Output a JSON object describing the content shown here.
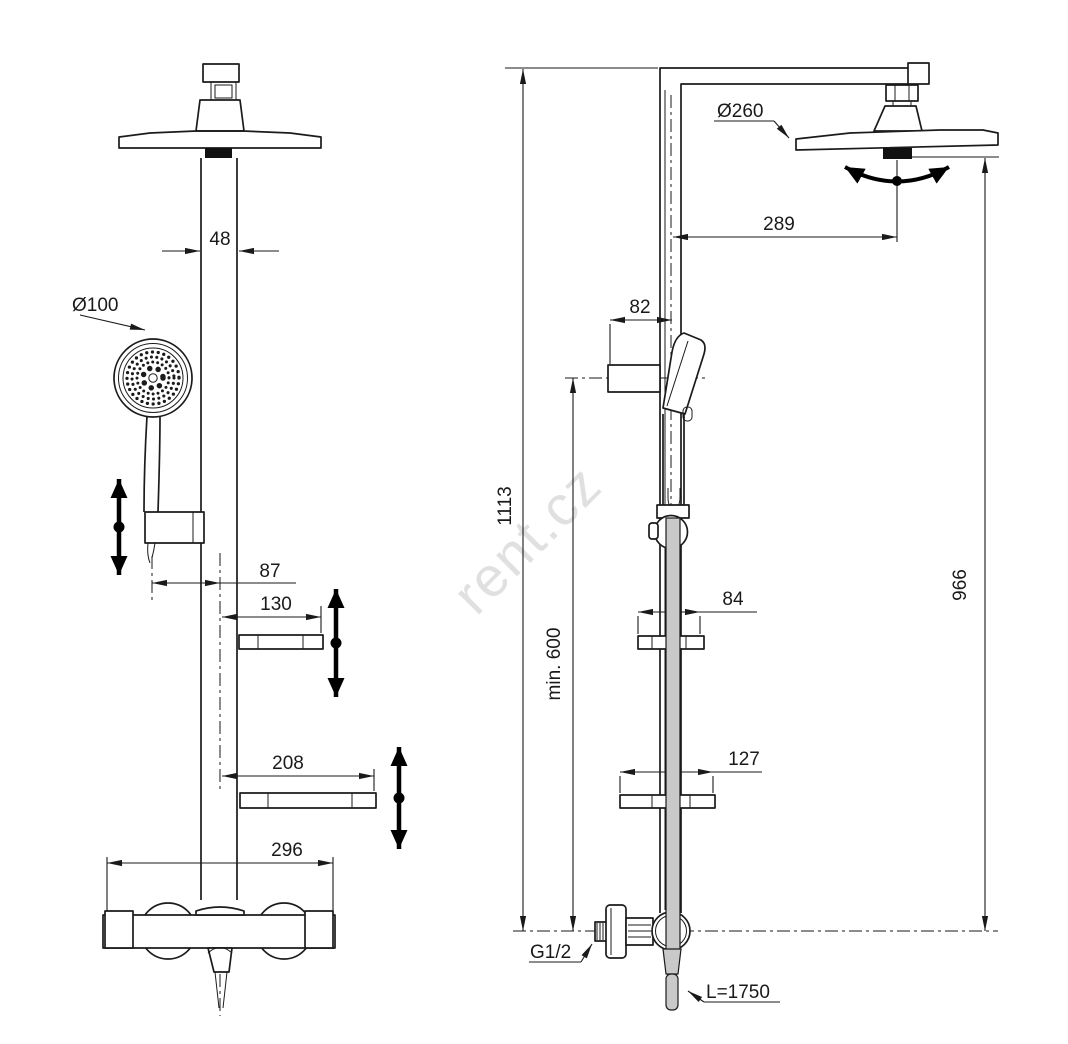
{
  "watermark": {
    "text": "rent.cz"
  },
  "front_view": {
    "dimensions": {
      "pipe_width": "48",
      "hand_shower_diameter": "Ø100",
      "hand_shower_offset": "87",
      "upper_shelf_width": "130",
      "lower_shelf_width": "208",
      "mixer_width": "296"
    }
  },
  "side_view": {
    "dimensions": {
      "head_shower_diameter": "Ø260",
      "head_shower_reach": "289",
      "wall_bracket_depth": "82",
      "total_height": "1113",
      "min_mounting_height": "min. 600",
      "upper_shelf_depth": "84",
      "lower_shelf_depth": "127",
      "column_height": "966",
      "connection_thread": "G1/2",
      "hose_length": "L=1750"
    }
  }
}
